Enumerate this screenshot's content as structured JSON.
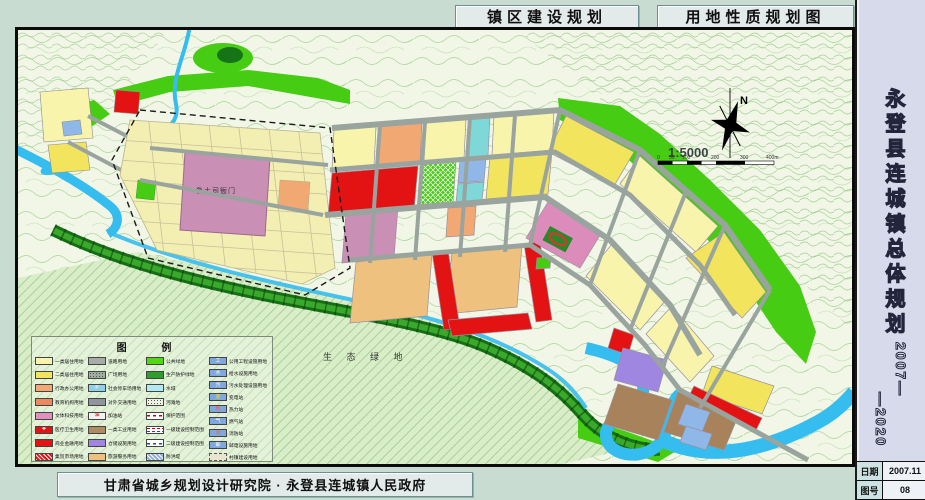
{
  "titles": {
    "construction": "镇区建设规划",
    "landuse": "用地性质规划图"
  },
  "sidebar": {
    "title": "永登县连城镇总体规划",
    "years_upper": "2007—",
    "years_lower": "—2020",
    "info_rows": [
      {
        "label": "日期",
        "value": "2007.11"
      },
      {
        "label": "图号",
        "value": "08"
      }
    ]
  },
  "footer": {
    "credit": "甘肃省城乡规划设计研究院 · 永登县连城镇人民政府"
  },
  "map": {
    "north_label": "N",
    "scale_text": "1:5000",
    "scale_ticks": [
      "0",
      "50",
      "100",
      "200",
      "300",
      "400m"
    ],
    "labels": {
      "yamen": "鲁土司衙门",
      "eco_green": "生 态 绿 地"
    }
  },
  "legend": {
    "title": "图 例",
    "columns": [
      [
        {
          "label": "一类居住用地",
          "color": "#f9f4ac"
        },
        {
          "label": "二类居住用地",
          "color": "#f2e45c"
        },
        {
          "label": "行政办公用地",
          "color": "#f2a873"
        },
        {
          "label": "教育机构用地",
          "color": "#ec8a5e"
        },
        {
          "label": "文体科技用地",
          "color": "#e091bd"
        },
        {
          "label": "医疗卫生用地",
          "color": "#e31313",
          "sym": "✚"
        },
        {
          "label": "商业金融用地",
          "color": "#e31313"
        },
        {
          "label": "集贸市场用地",
          "color": "#e31313",
          "cls": "sw-hatch-white"
        }
      ],
      [
        {
          "label": "道路用地",
          "color": "#a7aca7"
        },
        {
          "label": "广场用地",
          "color": "#9fae9f",
          "cls": "sw-dots"
        },
        {
          "label": "社会停车场用地",
          "color": "#8fd2e8",
          "sym": "P"
        },
        {
          "label": "对外交通用地",
          "color": "#8f959d"
        },
        {
          "label": "加油站",
          "color": "#f2f2f2",
          "sym": "油",
          "symColor": "#c00"
        },
        {
          "label": "一类工业用地",
          "color": "#b08a60"
        },
        {
          "label": "仓储设施用地",
          "color": "#9f86e0"
        },
        {
          "label": "旅游服务用地",
          "color": "#eec27e"
        }
      ],
      [
        {
          "label": "公共绿地",
          "color": "#52d813"
        },
        {
          "label": "生产防护绿地",
          "color": "#2f9e2f"
        },
        {
          "label": "水域",
          "color": "#b3e9f2"
        },
        {
          "label": "河滩地",
          "color": "#eef2e2",
          "cls": "sw-dots"
        },
        {
          "label": "保护范围",
          "cls": "sw-line-reddash"
        },
        {
          "label": "一级建设控制范围",
          "cls": "sw-line-redblue"
        },
        {
          "label": "二级建设控制范围",
          "cls": "sw-line-bluedash"
        },
        {
          "label": "防洪堤",
          "color": "#8fb0dd",
          "cls": "sw-hatch-white"
        }
      ],
      [
        {
          "label": "公用工程设施用地",
          "color": "#7fa9dc",
          "sym": "工"
        },
        {
          "label": "给水设施用地",
          "color": "#7fa9dc",
          "sym": "水"
        },
        {
          "label": "污水处理设施用地",
          "color": "#7fa9dc",
          "sym": "污"
        },
        {
          "label": "变电站",
          "color": "#7fa9dc",
          "sym": "变",
          "symColor": "#ffdd00"
        },
        {
          "label": "热力站",
          "color": "#7fa9dc",
          "sym": "热",
          "symColor": "#ff5555"
        },
        {
          "label": "燃气站",
          "color": "#7fa9dc",
          "sym": "气"
        },
        {
          "label": "消防站",
          "color": "#7fa9dc",
          "sym": "消",
          "symColor": "#ff5555"
        },
        {
          "label": "邮电设施用地",
          "color": "#7fa9dc",
          "sym": "邮"
        },
        {
          "label": "村镇建设用地",
          "color": "#e8e4d0",
          "cls": "sw-dashed"
        }
      ]
    ]
  }
}
